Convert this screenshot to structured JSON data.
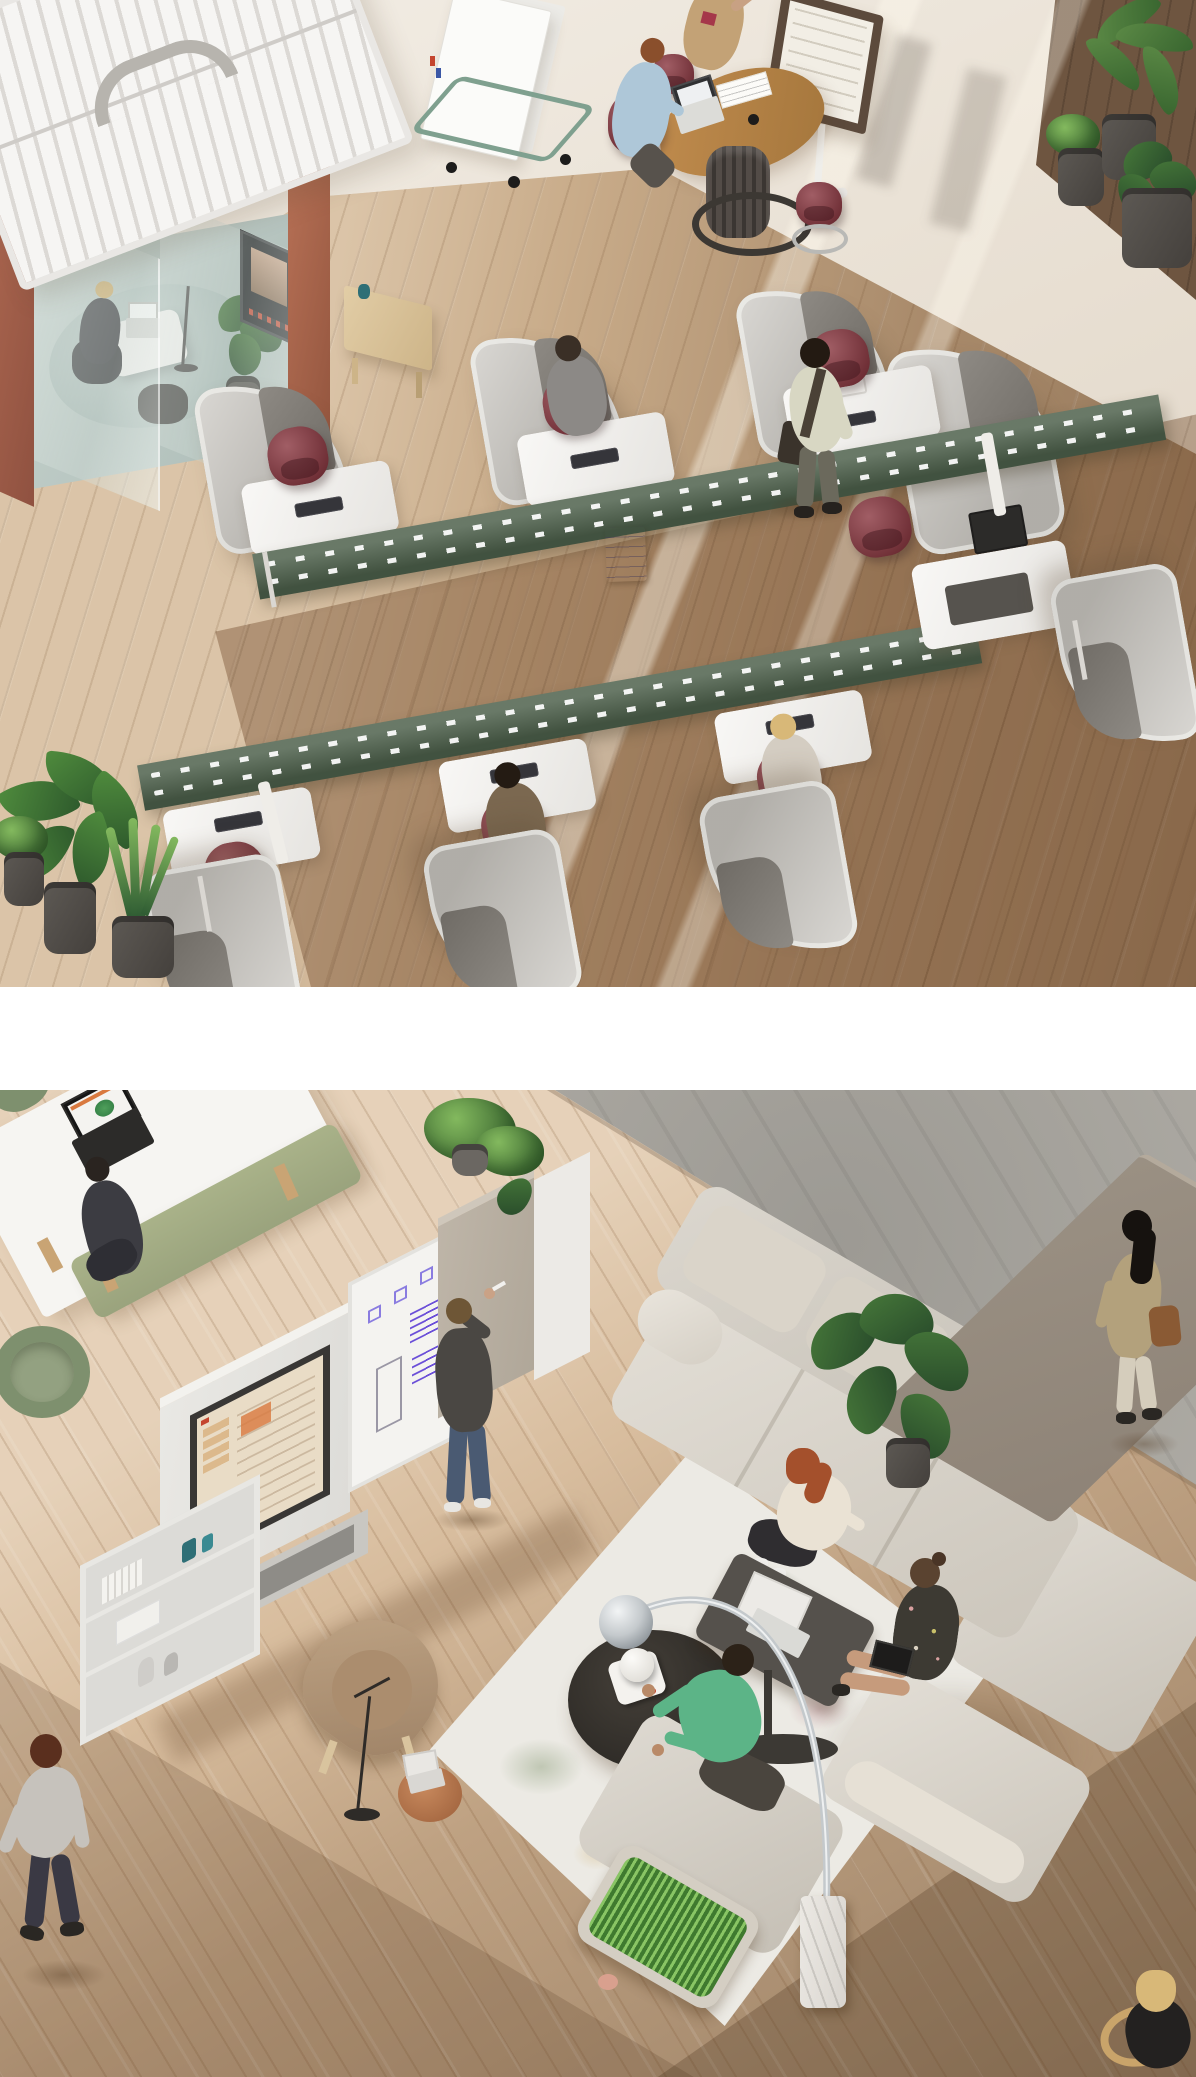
{
  "meta": {
    "title": "Aerial office environment renders",
    "width": 1196,
    "height": 2077,
    "layout": "Two aerial photographic renders of an office stacked vertically, separated by a white band",
    "visible_text": "none"
  },
  "palette": {
    "page_bg": "#ffffff",
    "concrete_light": "#efe9e0",
    "concrete_mid": "#ddd2c3",
    "wood_light": "#c8ab89",
    "wood_dark": "#8a6544",
    "walnut": "#6e5540",
    "pod_terracotta": "#b06a52",
    "roof_white": "#f6f5f3",
    "cart_green": "#7fa08f",
    "table_wood": "#b9854e",
    "stool_maroon": "#8e3b44",
    "screen_frame": "#5c4a3c",
    "spine_green": "#4c5f4a",
    "desk_white": "#f2f0ec",
    "keyboard_dark": "#35353a",
    "hood_felt": "#c4c1bb",
    "hood_inner": "#8e8a84",
    "chair_maroon": "#8c3a43",
    "pot_gray": "#5d5954",
    "plant_green": "#4c7a3b",
    "b_wood": "#d8bd9e",
    "b_concrete": "#b6b3ac",
    "b_table_white": "#f6f5f2",
    "bench_green": "#a9b289",
    "chair_green": "#7e906e",
    "cab_white": "#e9e8e4",
    "tv_frame": "#393735",
    "tv_face": "#e9dcc6",
    "tv_accent": "#d9793f",
    "note_purple": "#6b4fd8",
    "felt_panel": "#b0a799",
    "rug_base": "#eceae4",
    "sofa_beige": "#d2ccc1",
    "panel_taupe": "#8e8377",
    "coffee_dark": "#2c2925",
    "lamp_chrome": "#c4c9cc",
    "marble": "#ece9e4",
    "grass_green": "#3f7a2f",
    "sweater_green": "#5cb487",
    "jeans_blue": "#4a5a72",
    "charcoal": "#4a4743",
    "coat_tan": "#b3a17c",
    "hair_red": "#a4502c",
    "hair_blonde": "#d8b878"
  },
  "scenes": {
    "top": {
      "label": "Aerial view of an open-plan office with focus desk pods",
      "objects": {
        "meeting_pod": "Glass meeting pod with white slatted roof and terracotta panels, woman on laptop inside",
        "whiteboard_cart": "Mobile double whiteboard cart with sage-green frame and casters",
        "standing_table": "Standing-height kidney table with laptop, papers and two burgundy stools; man seated, woman waving",
        "display_stand": "Framed presentation display on white stand",
        "desk_system": "Back-to-back bench desks with dark-green perforated spine, grey felt privacy hoods and burgundy task chairs",
        "desk_workers": "Four people working at the hooded desks",
        "walking_man": "Man with shoulder bag walking past the desks",
        "plants_right": "Three potted plants on dark walnut floor, top right",
        "plants_left": "Monstera, snake plant and fern in grey pots, bottom left"
      }
    },
    "bottom": {
      "label": "Aerial view of a collaboration lounge with media wall and modular sofa",
      "objects": {
        "work_table": "White table with open laptop, upholstered green bench and green tub chairs; one person seated",
        "media_wall": "Modular white storage wall with large display, whiteboard with purple sticky notes, felt end panel and trailing plant",
        "presenter": "Man in charcoal sweater and jeans writing on the whiteboard",
        "shelving": "Low open shelving with books, boxes and teal vases",
        "sofa": "Beige modular high-back sofa with tall taupe privacy screen and rubber plant",
        "sofa_people": "Red-haired woman with laptop, woman in floral dress with tablet, man in green sweater talking",
        "rug": "Floral watercolour area rug",
        "coffee_table": "Round dark coffee table with white smart-speaker dome on tray",
        "arc_lamp": "Chrome arc floor lamp with marble block base",
        "lounge_chair": "Tan leather lounge chair on the rug",
        "side_table": "Small copper side table with open laptop, microphone stand beside it",
        "grass_planter": "Sofa-end planter box full of grass",
        "walking_man": "Man in grey shirt walking across the wood floor, bottom left",
        "walking_woman": "Woman with tan coat and tote bag walking on the concrete strip, right",
        "corner_sitter": "Blonde person seated on wooden chair, cut off at the bottom-right corner"
      }
    }
  }
}
